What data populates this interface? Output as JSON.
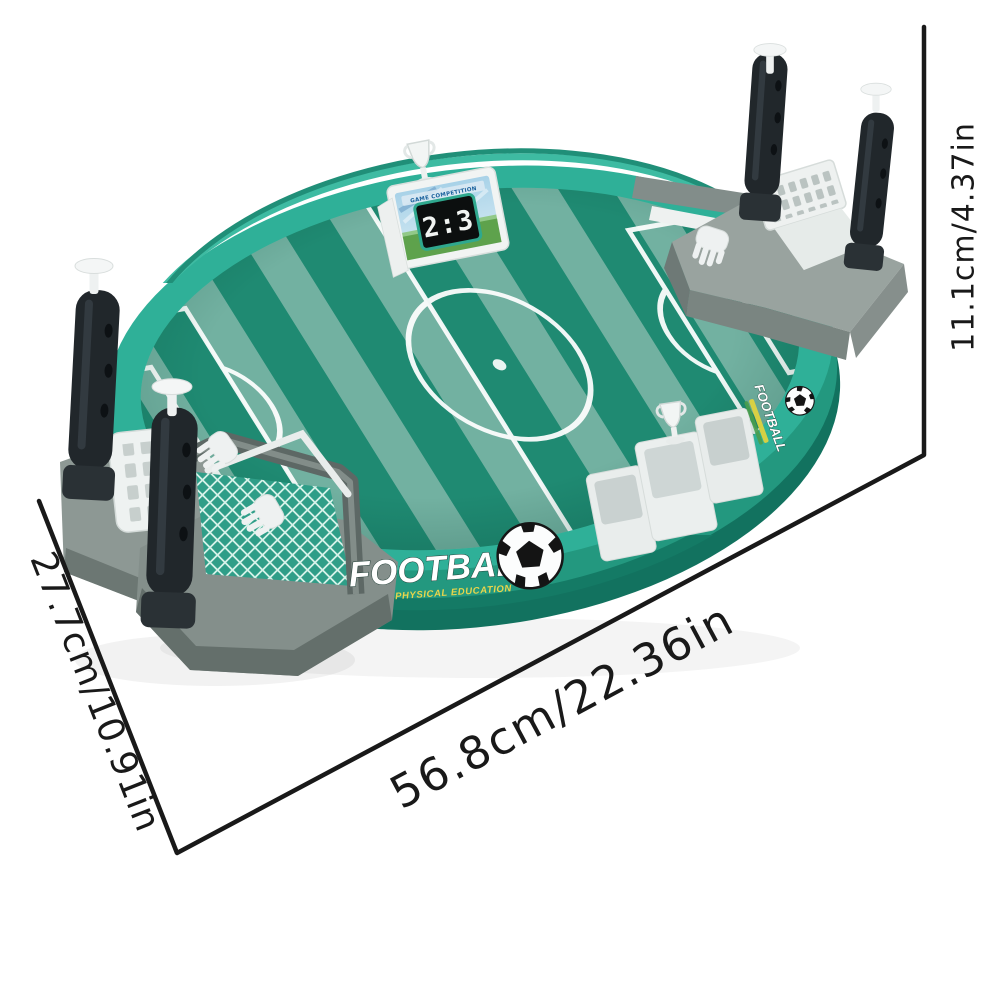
{
  "page": {
    "background": "#ffffff"
  },
  "product": {
    "kind": "tabletop-football-board-game",
    "scoreboard": {
      "header": "GAME COMPETITION",
      "score": "2:3"
    },
    "front_logo": {
      "title": "FOOTBALL",
      "subtitle": "PHYSICAL EDUCATION"
    },
    "side_logo": {
      "title": "FOOTBALL"
    },
    "colors": {
      "rim_top": "#2fb098",
      "rim_wall": "#23987f",
      "rim_dark": "#12725f",
      "field_dark_stripe": "#1f8a72",
      "field_light_stripe": "#72b1a1",
      "field_line": "#ffffff",
      "grey_plastic": "#99a39f",
      "grey_dark": "#6c7773",
      "handle_black": "#21272b",
      "white_plastic": "#eef1f1",
      "logo_yellow": "#e9d54b",
      "score_border_green": "#2fa88e",
      "dimension_line": "#191919"
    }
  },
  "dimensions": {
    "height": {
      "label": "11.1cm/4.37in"
    },
    "length": {
      "label": "56.8cm/22.36in"
    },
    "width": {
      "label": "27.7cm/10.91in"
    }
  }
}
